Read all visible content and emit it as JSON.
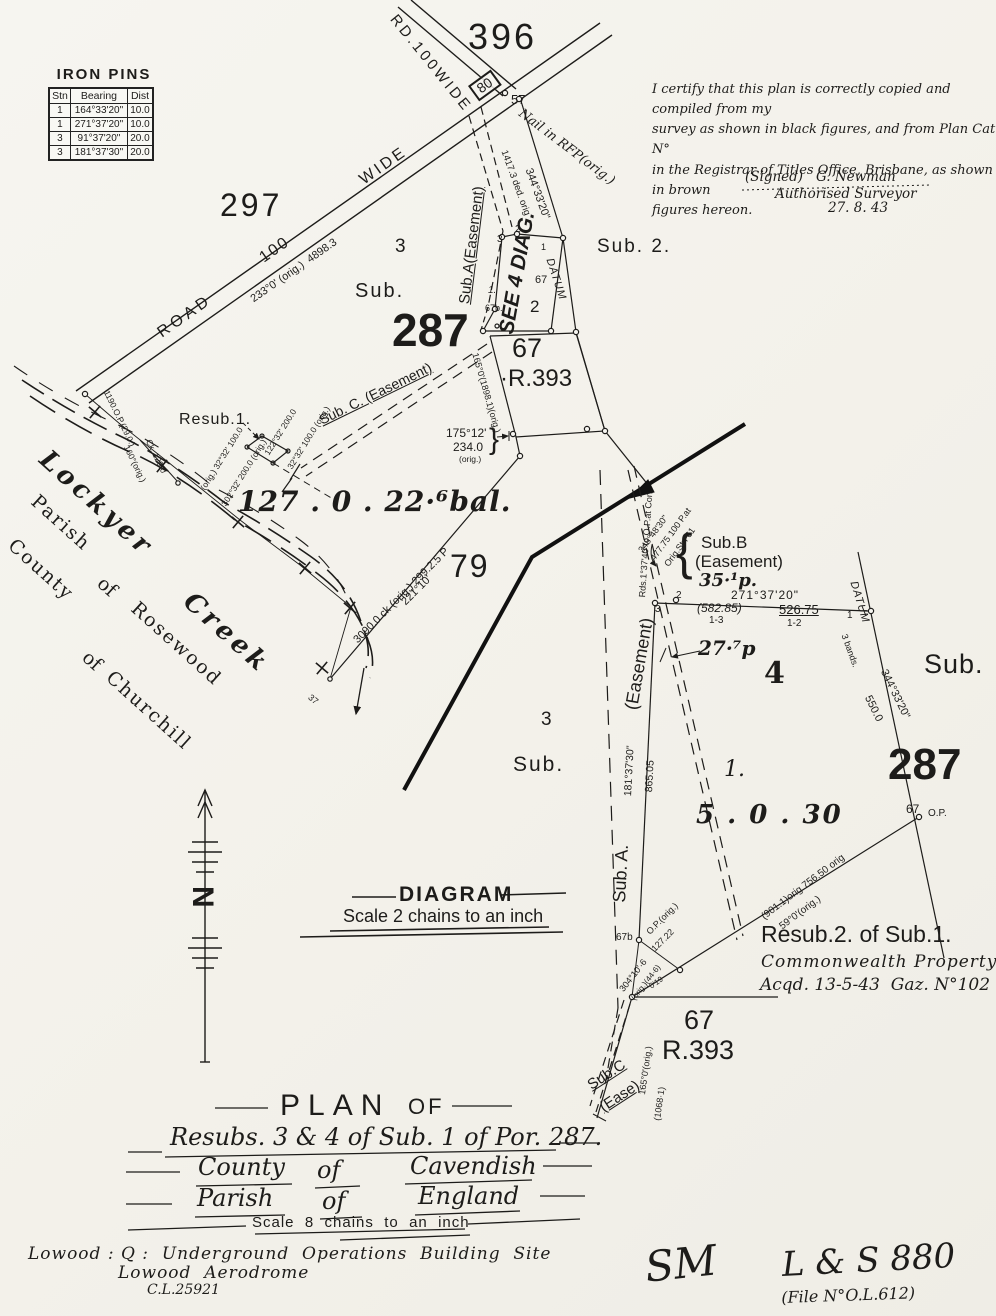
{
  "colors": {
    "paper": "#f4f2ec",
    "ink": "#1d1c1a"
  },
  "iron_pins": {
    "title": "IRON PINS",
    "headers": [
      "Stn",
      "Bearing",
      "Dist"
    ],
    "rows": [
      [
        "1",
        "164°33'20\"",
        "10.0"
      ],
      [
        "1",
        "271°37'20\"",
        "10.0"
      ],
      [
        "3",
        "91°37'20\"",
        "20.0"
      ],
      [
        "3",
        "181°37'30\"",
        "20.0"
      ]
    ]
  },
  "certification": {
    "line1": "I certify that this plan is correctly copied and compiled from my",
    "line2": "survey as shown in black figures, and from Plan Cat N°",
    "line3": "in the Registrar of Titles Office, Brisbane, as shown in brown",
    "line4": "figures hereon.",
    "signed": "(Signed)   G. Newman",
    "role": "Authorised Surveyor",
    "date": "27. 8. 43"
  },
  "diagram_heading": {
    "title": "DIAGRAM",
    "scale": "Scale 2 chains to an inch"
  },
  "title_block": {
    "plan": "PLAN",
    "of": "OF",
    "subject": "Resubs. 3 & 4 of Sub. 1 of Por. 287.",
    "county": "County",
    "of1": "of",
    "cavendish": "Cavendish",
    "parish": "Parish",
    "of2": "of",
    "england": "England",
    "scale": "Scale  8  chains  to  an  inch"
  },
  "footer": {
    "site": "Lowood : Q :  Underground  Operations  Building  Site",
    "aerodrome": "Lowood  Aerodrome",
    "ref": "C.L.25921",
    "sm": "SM",
    "ls880": "L & S 880",
    "file": "(File N°O.L.612)"
  },
  "labels": {
    "por396": "396",
    "rd100wide": "RD.100WIDE",
    "road80": "80",
    "s57": "57",
    "nail_rfp": "Nail in RFP(orig.)",
    "b1417": "1417.3 ded. orig",
    "b344_top": "344°33'20\"",
    "datum_top": "DATUM",
    "subA_top": "Sub.A(Easement)",
    "see4diag": "SEE 4 DIAG.",
    "sub2": "Sub. 2.",
    "st3a": "3",
    "st2a": "2",
    "st1a": "1",
    "n67a": "67",
    "p2": "2",
    "n67b_a": "67b.",
    "p1a": "1.",
    "por297": "297",
    "road_word": "ROAD",
    "road_100": "100",
    "road_wide": "WIDE",
    "b233": "233°0' (orig.)  4898.3",
    "sub3_top": "Sub.",
    "n3_top": "3",
    "big287_top": "287",
    "n67_top": "67",
    "r393_top": "·R.393",
    "b165_top": "165°0'(1898.1)(orig.)",
    "b175_1": "175°12'",
    "b175_2": "234.0",
    "b175_3": "(orig.)",
    "brace175": "}",
    "subC_top": "Sub. C. (Easement)",
    "resub1": "Resub.1.",
    "r1b1": "122°32' 200.0",
    "r1b2": "32°32' 100.0 (orig.)",
    "r1b3": "(orig.) 32°32' 100.0",
    "r1b4": "302°32' 200.0 (orig.)",
    "area127": "127 . 0 . 22·⁶bal.",
    "b3090": "3090.0 ck (orig.) 299.2.5 P",
    "b221": "221°10'",
    "por79": "79",
    "lockyer": "Lockyer",
    "creek_w": "Creek",
    "parish_w": "Parish",
    "of_1": "of",
    "rosewood": "Rosewood",
    "county_w": "County",
    "of_2": "of",
    "churchill": "Churchill",
    "cm1": "1190.O.P.(29.0.)",
    "cm2": "Ck. 129.0",
    "cm3": "160°(orig.)",
    "c37": "37",
    "subB_brace": "{",
    "subB1": "Sub.B",
    "subB2": "(Easement)",
    "subB3": "35·¹p.",
    "rds137": "Rds.1°37'40\"to O.P.at Cor:",
    "b348_1": "348°48'30\"",
    "b348_2": "477.75 100 P.at",
    "b348_3": "Orig.Stn 61",
    "b271_low": "271°37'20\"",
    "b58285": "(582.85)",
    "b13": "1-3",
    "b52675": "526.75",
    "b12": "1-2",
    "st2b": "2",
    "st3b": "3",
    "st1b": "1",
    "datum_low": "DATUM",
    "b3bands": "3 bands.",
    "b344_low": "344°33'20\"",
    "b550": "550.0",
    "n4": "4",
    "n1b": "1.",
    "area530": "5 . 0 . 30",
    "b277": "27·⁷p",
    "b865": "865.05",
    "b181": "181°37'30\"",
    "subA_low": "Sub. A.",
    "ease_low": "(Easement)",
    "sub3_low": "Sub.",
    "n3_low": "3",
    "big287_low": "287",
    "sub_right": "Sub.",
    "n67_op": "67",
    "op_b": "O.P.",
    "b901": "(901.1)orig 756.50 orig",
    "b59": "59°0'(orig.)",
    "op127_1": "O.P.(orig.)",
    "op127_2": "127.22",
    "n67b_low": "67b",
    "b304": "304°10'·6",
    "b446": "(orig.)(44·6)",
    "b019": "0'19",
    "resub2_title": "Resub.2. of Sub.1.",
    "resub2_cw": "Commonwealth Property",
    "resub2_acqd": "Acqd. 13-5-43  Gaz. N°102",
    "n67_low": "67",
    "r393_low": "R.393",
    "subC_low1": "Sub.C",
    "subC_low2": "(Ease)",
    "b165_low": "165°0'(orig.)",
    "b1068": "(1068·1)",
    "n_letter": "N"
  }
}
